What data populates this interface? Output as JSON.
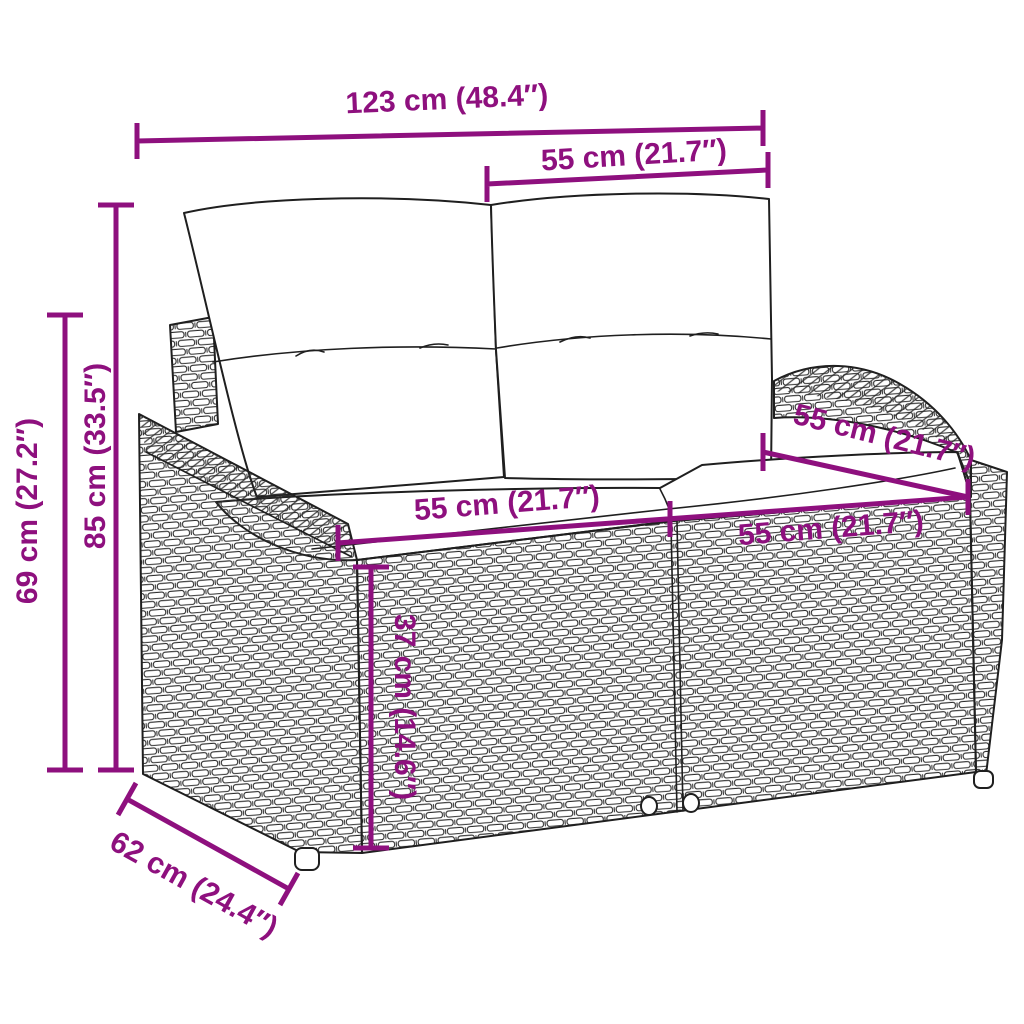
{
  "title": "Garden sofa dimension diagram",
  "product": "Poly rattan 2-seater garden sofa with white cushions",
  "colors": {
    "dimension_accent": "#8E107E",
    "line_art": "#1f1f1f",
    "background": "#ffffff"
  },
  "dimensions": [
    {
      "name": "overall-width",
      "label": "123 cm (48.4″)"
    },
    {
      "name": "backrest-cushion-width",
      "label": "55 cm (21.7″)"
    },
    {
      "name": "total-height",
      "label": "85 cm (33.5″)"
    },
    {
      "name": "armrest-height",
      "label": "69 cm (27.2″)"
    },
    {
      "name": "seat-height",
      "label": "37 cm (14.6″)"
    },
    {
      "name": "seat-depth",
      "label": "62 cm (24.4″)"
    },
    {
      "name": "armrest-top-depth",
      "label": "55 cm (21.7″)"
    },
    {
      "name": "seat-width-left",
      "label": "55 cm (21.7″)"
    },
    {
      "name": "seat-width-right",
      "label": "55 cm (21.7″)"
    }
  ]
}
